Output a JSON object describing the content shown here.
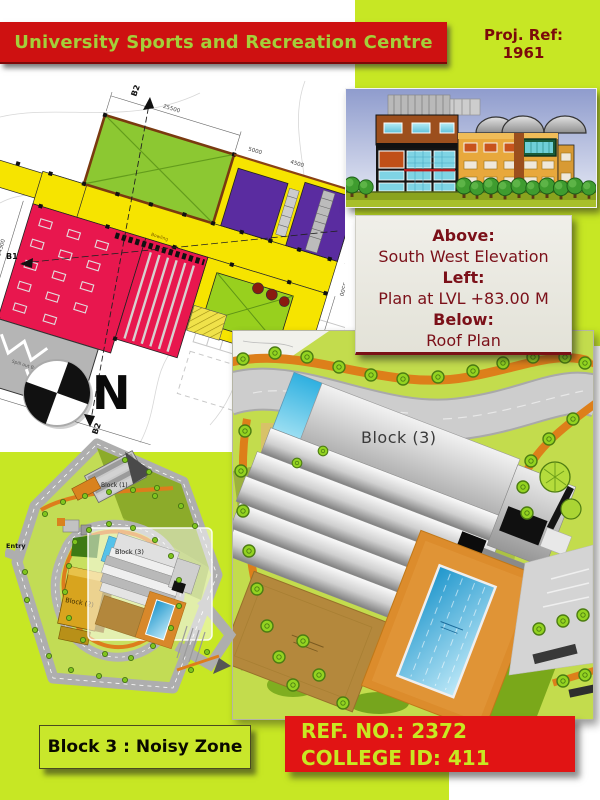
{
  "header": {
    "title": "University Sports and Recreation Centre",
    "proj_ref_label": "Proj. Ref:",
    "proj_ref_value": "1961"
  },
  "caption_box": {
    "above_label": "Above:",
    "above_value": "South West Elevation",
    "left_label": "Left:",
    "left_value": "Plan at LVL +83.00 M",
    "below_label": "Below:",
    "below_value": "Roof Plan"
  },
  "floor_plan": {
    "section_b1": "B1",
    "section_b2": "B2",
    "north_letter": "N",
    "bowling_label": "Bowling",
    "balcony_label": "Spill out Balcony",
    "dims": [
      "25500",
      "5000",
      "4500",
      "7400",
      "6200",
      "3500",
      "14300",
      "13500",
      "11500"
    ]
  },
  "roof_plan": {
    "block_label": "Block (3)"
  },
  "site_plan": {
    "block1_label": "Block (1)",
    "block2_label": "Block (2)",
    "block3_label": "Block (3)",
    "entry_label": "Entry"
  },
  "footer": {
    "zone_label": "Block 3 : Noisy Zone",
    "ref_no": "REF. NO.: 2372",
    "college_id": "COLLEGE ID: 411"
  },
  "colors": {
    "lime_background": "#c7e724",
    "banner_red": "#ce1111",
    "banner_text_green": "#a4cf3a",
    "caption_maroon": "#7b1019",
    "plan_yellow": "#f6e400",
    "plan_green": "#8cc832",
    "plan_purple": "#5a2ca0",
    "plan_red": "#e8174e",
    "pool_blue": "#3fb4e4",
    "path_orange": "#dd7f1a",
    "ref_box_red": "#e11414"
  }
}
